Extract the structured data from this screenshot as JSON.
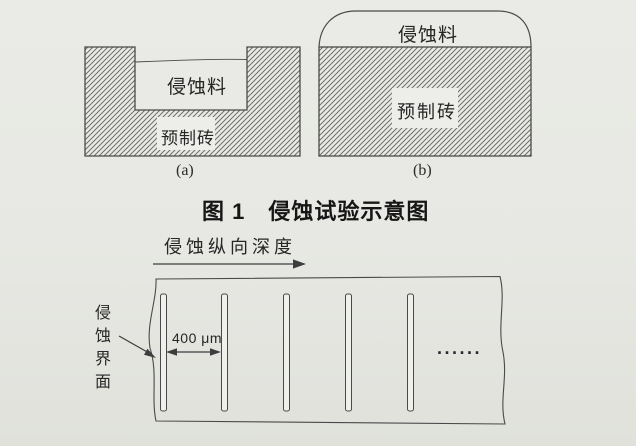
{
  "figure1": {
    "diagram_a": {
      "erosion_label": "侵蚀料",
      "brick_label": "预制砖",
      "caption": "(a)"
    },
    "diagram_b": {
      "erosion_label": "侵蚀料",
      "brick_label": "预制砖",
      "caption": "(b)"
    },
    "caption": "图 1　侵蚀试验示意图"
  },
  "figure2": {
    "depth_label": "侵蚀纵向深度",
    "spacing_label": "400 μm",
    "interface_label": "侵蚀界面",
    "continuation_dots": "······"
  },
  "colors": {
    "paper": "#e7e8e3",
    "line": "#4a4a4a",
    "hatch_line": "#6e6e6e",
    "label_box": "#edeeea",
    "text": "#262626"
  }
}
